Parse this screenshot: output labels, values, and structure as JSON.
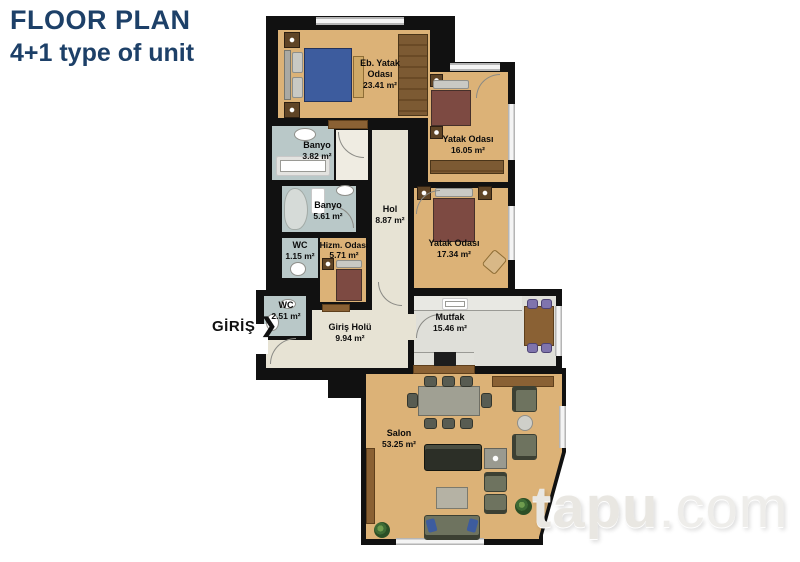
{
  "header": {
    "title": "FLOOR PLAN",
    "subtitle": "4+1 type of unit",
    "title_color": "#1d4068"
  },
  "entrance": {
    "label": "GİRİŞ",
    "arrow": "❯"
  },
  "watermark": {
    "name": "tapu",
    "tld": ".com"
  },
  "colors": {
    "wall": "#111111",
    "floor_wood": "#dcb277",
    "floor_bath": "#b9c8c8",
    "floor_hall": "#e7e3d4",
    "floor_kitchen": "#dfdfd9",
    "bed_blue": "#3d5c9e",
    "bed_maroon": "#7d4a42",
    "watermark": "#e9e7e2"
  },
  "rooms": {
    "master_bedroom": {
      "name": "Eb. Yatak\nOdası",
      "area": "23.41 m²"
    },
    "bedroom_2": {
      "name": "Yatak Odası",
      "area": "16.05 m²"
    },
    "bathroom_1": {
      "name": "Banyo",
      "area": "3.82 m²"
    },
    "bathroom_2": {
      "name": "Banyo",
      "area": "5.61 m²"
    },
    "wc_1": {
      "name": "WC",
      "area": "1.15 m²"
    },
    "service_room": {
      "name": "Hizm. Odası",
      "area": "5.71 m²"
    },
    "hall": {
      "name": "Hol",
      "area": "8.87 m²"
    },
    "bedroom_3": {
      "name": "Yatak Odası",
      "area": "17.34 m²"
    },
    "wc_2": {
      "name": "WC",
      "area": "2.51 m²"
    },
    "entrance_hall": {
      "name": "Giriş Holü",
      "area": "9.94 m²"
    },
    "kitchen": {
      "name": "Mutfak",
      "area": "15.46 m²"
    },
    "living_room": {
      "name": "Salon",
      "area": "53.25 m²"
    }
  }
}
